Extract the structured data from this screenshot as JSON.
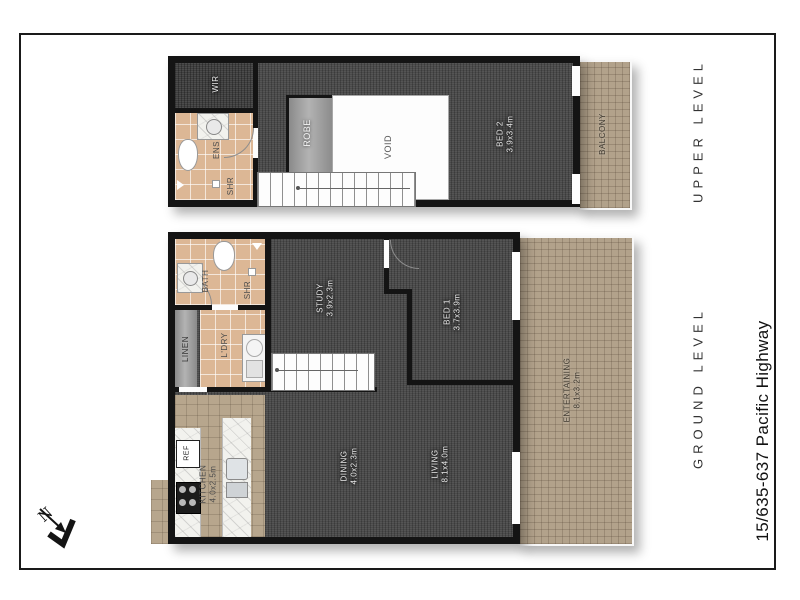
{
  "address": "15/635-637 Pacific Highway",
  "upper": {
    "label": "UPPER LEVEL",
    "rooms": {
      "wir": {
        "name": "WIR"
      },
      "ens": {
        "name": "ENS"
      },
      "shr": {
        "name": "SHR"
      },
      "robe": {
        "name": "ROBE"
      },
      "void": {
        "name": "VOID"
      },
      "bed2": {
        "name": "BED 2",
        "dims": "3.9x3.4m"
      },
      "balcony": {
        "name": "BALCONY"
      }
    }
  },
  "ground": {
    "label": "GROUND LEVEL",
    "rooms": {
      "bath": {
        "name": "BATH"
      },
      "shr": {
        "name": "SHR"
      },
      "linen": {
        "name": "LINEN"
      },
      "ldry": {
        "name": "L'DRY"
      },
      "study": {
        "name": "STUDY",
        "dims": "3.9x2.3m"
      },
      "bed1": {
        "name": "BED 1",
        "dims": "3.7x3.9m"
      },
      "kitchen": {
        "name": "KITCHEN",
        "dims": "4.0x2.5m"
      },
      "ref": {
        "name": "REF"
      },
      "dining": {
        "name": "DINING",
        "dims": "4.0x2.3m"
      },
      "living": {
        "name": "LIVING",
        "dims": "8.1x4.0m"
      },
      "entertaining": {
        "name": "ENTERTAINING",
        "dims": "8.1x3.2m"
      }
    }
  },
  "compass": {
    "label": "N"
  },
  "colors": {
    "wall": "#141414",
    "carpet": "#4a4a4a",
    "tile": "#dcb795",
    "paver": "#b2a28b",
    "marble": "#f2f2ee",
    "unit_gray": "#9c9c9c"
  }
}
